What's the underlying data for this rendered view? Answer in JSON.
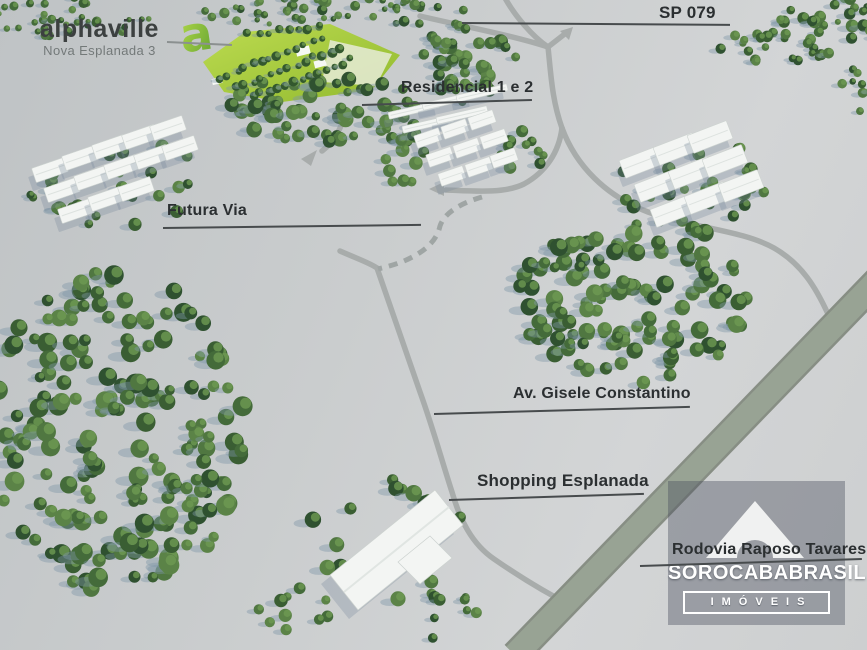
{
  "logo": {
    "glyph": "a",
    "brand": "alphaville",
    "subtitle": "Nova Esplanada 3"
  },
  "map_labels": {
    "highway_top": "SP 079",
    "residencial": "Residencial 1 e 2",
    "future_road": "Futura Via",
    "avenue": "Av. Gisele Constantino",
    "shopping": "Shopping Esplanada",
    "highway_bottom": "Rodovia Raposo Tavares"
  },
  "watermark": {
    "icon": "roof-arch-icon",
    "name": "SOROCABABRASIL",
    "tagline": "IMÓVEIS"
  },
  "colors": {
    "terrain": "#cbcecf",
    "road": "#a8acab",
    "highway": "#95a090",
    "development_green": "#a9cf3f",
    "tree_green": "#3a5e33",
    "building_white": "#f3f5f3",
    "label_text": "#2b2f31",
    "logo_green": "#8cc63f",
    "watermark_bg": "#484e5c"
  }
}
